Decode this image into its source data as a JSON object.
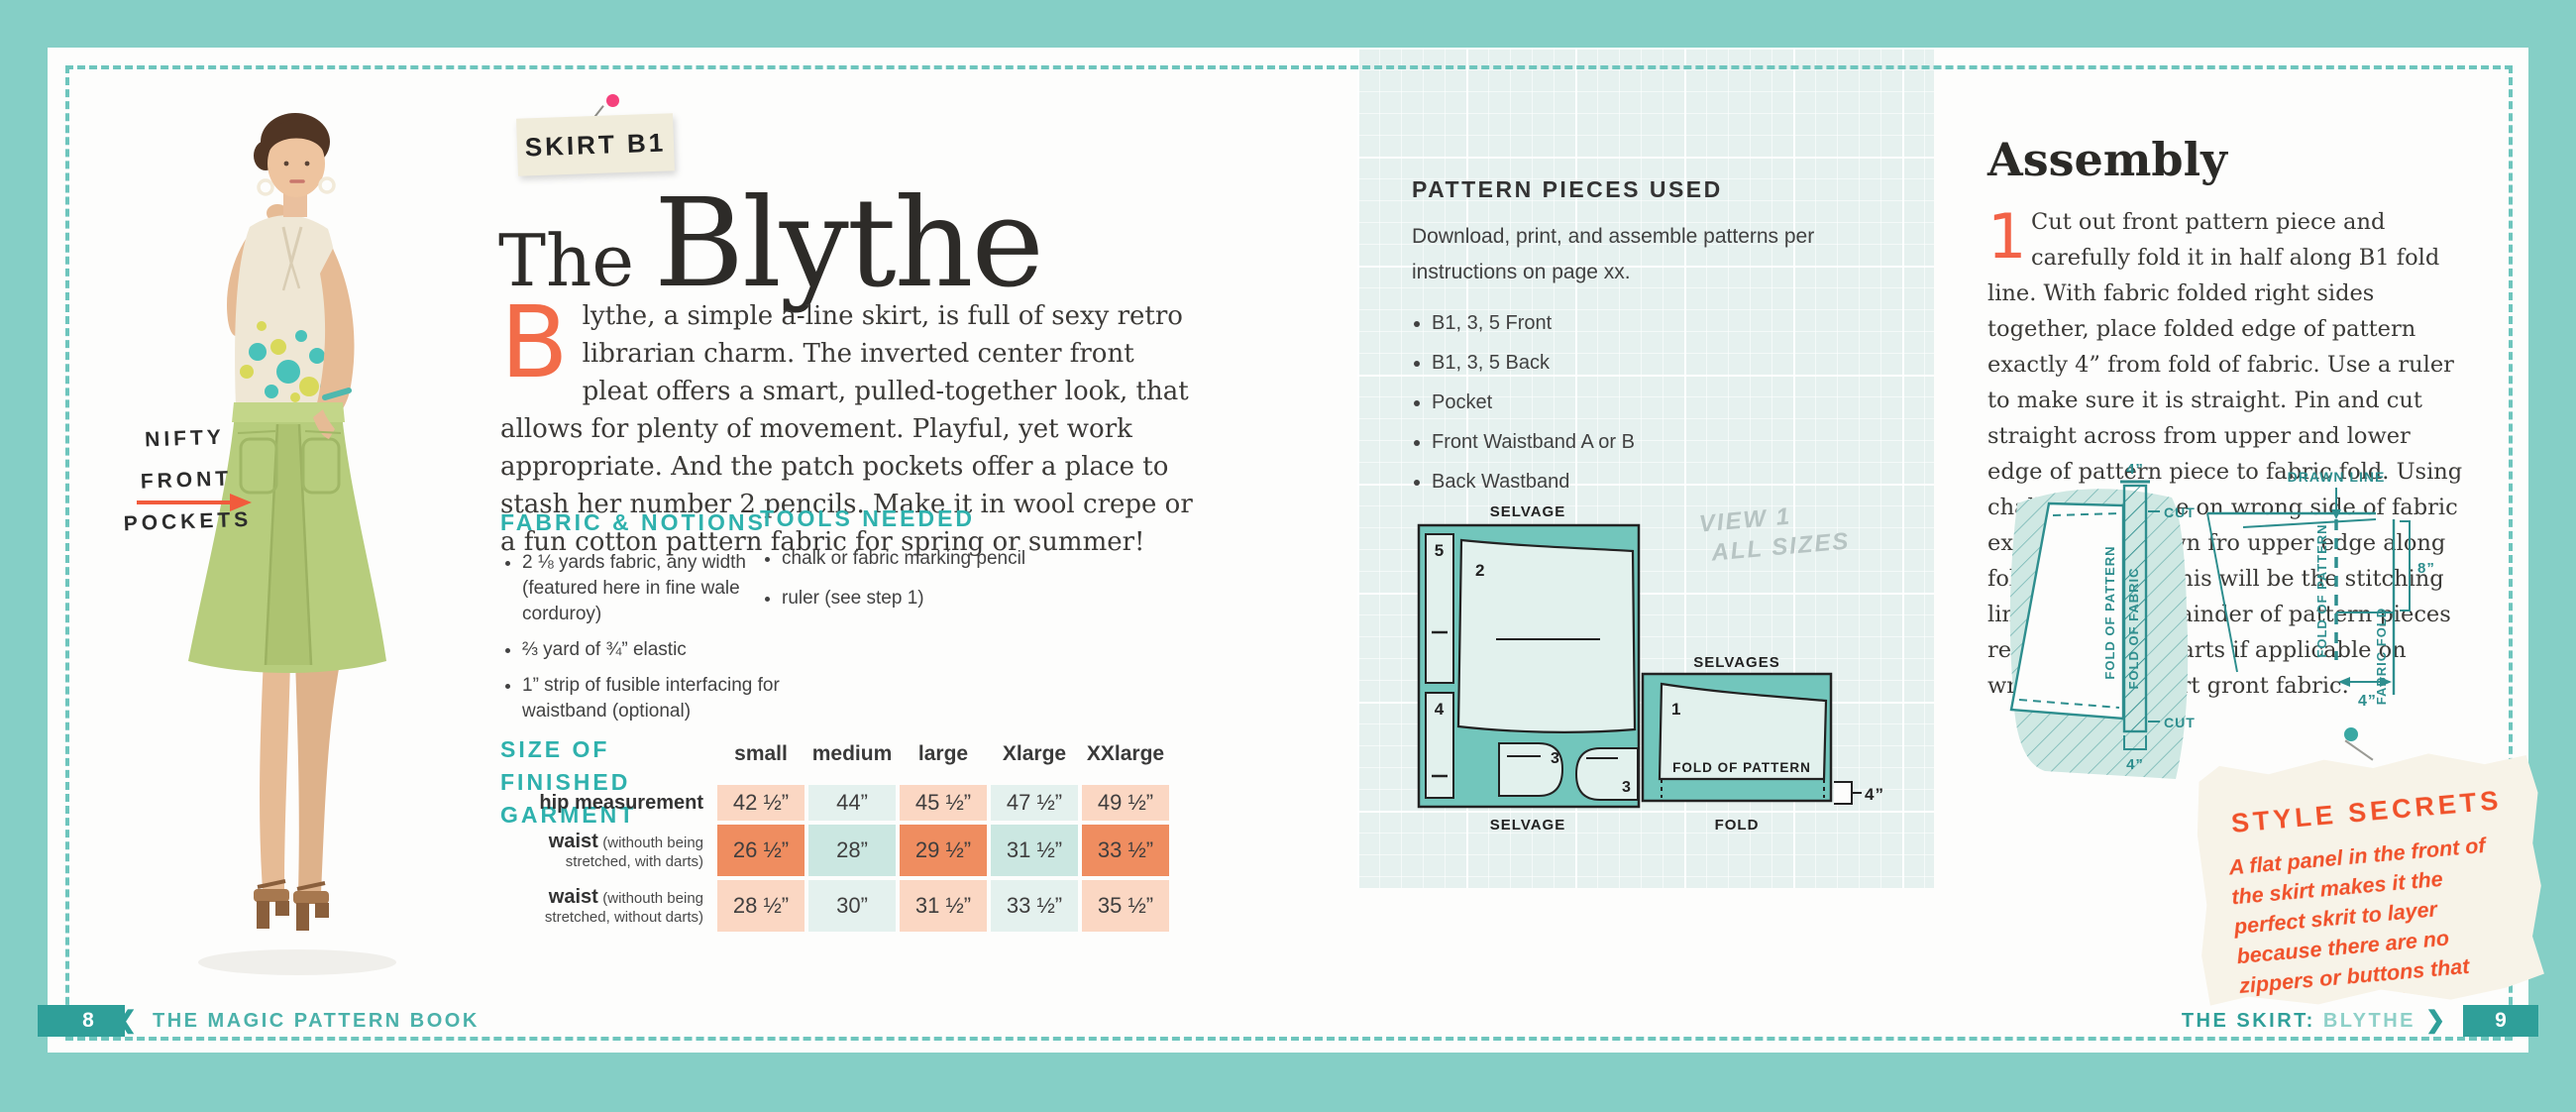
{
  "colors": {
    "background": "#85cfc6",
    "dashed_border": "#6ec5bd",
    "ribbon_teal": "#2f9f99",
    "heading_teal": "#2fb1ad",
    "accent_orange": "#f26247",
    "note_orange": "#f0512a",
    "table_peach": "#fbd7c3",
    "table_teal_light": "#e4f1ee",
    "table_orange": "#ef8d60",
    "table_teal_mid": "#cbe7e1",
    "skirt_green": "#b7cd7d"
  },
  "left_page": {
    "photo_annotation": {
      "line1": "NIFTY",
      "line2": "FRONT",
      "line3": "POCKETS"
    },
    "tag_label": "SKIRT B1",
    "title": {
      "small": "The",
      "large": "Blythe"
    },
    "intro": {
      "dropcap": "B",
      "text": "lythe, a simple a-line skirt, is full of sexy retro librarian charm. The inverted center front pleat offers a smart, pulled-together look, that allows for plenty of movement. Playful, yet work appropriate. And the patch pockets offer a place to stash her number 2 pencils. Make it in wool crepe or a fun cotton pattern fabric for spring or summer!"
    },
    "fabric_notions": {
      "heading": "FABRIC & NOTIONS",
      "items": [
        "2 ⅛ yards fabric, any width (featured here in fine wale corduroy)",
        "⅔ yard of ¾” elastic",
        "1” strip of fusible interfacing for waistband (optional)"
      ]
    },
    "tools": {
      "heading": "TOOLS NEEDED",
      "items": [
        "chalk or fabric marking pencil",
        "ruler (see step 1)"
      ]
    },
    "size_table": {
      "heading": [
        "SIZE OF FINISHED",
        "GARMENT"
      ],
      "columns": [
        "small",
        "medium",
        "large",
        "Xlarge",
        "XXlarge"
      ],
      "rows": [
        {
          "label": "hip measurement",
          "note": "",
          "values": [
            "42 ½”",
            "44”",
            "45 ½”",
            "47 ½”",
            "49 ½”"
          ]
        },
        {
          "label": "waist",
          "note": "(withouth being stretched, with darts)",
          "values": [
            "26 ½”",
            "28”",
            "29 ½”",
            "31 ½”",
            "33 ½”"
          ]
        },
        {
          "label": "waist",
          "note": "(withouth being stretched, without darts)",
          "values": [
            "28 ½”",
            "30”",
            "31 ½”",
            "33 ½”",
            "35 ½”"
          ]
        }
      ]
    },
    "footer": {
      "page_number": "8",
      "chevron": "❮",
      "title": "THE MAGIC PATTERN BOOK"
    }
  },
  "right_page": {
    "pattern_pieces": {
      "heading": "PATTERN PIECES USED",
      "intro": "Download, print, and assemble patterns per instructions on page xx.",
      "items": [
        "B1, 3, 5 Front",
        "B1, 3, 5 Back",
        "Pocket",
        "Front Waistband A or B",
        "Back Wastband"
      ]
    },
    "pencil_note": {
      "line1": "VIEW 1",
      "line2": "ALL SIZES"
    },
    "layout_diagram": {
      "selvage_top": "SELVAGE",
      "selvage_bottom": "SELVAGE",
      "selvages": "SELVAGES",
      "fold": "FOLD",
      "fold_of_pattern": "FOLD OF PATTERN",
      "measure_4": "4”",
      "piece_1": "1",
      "piece_2": "2",
      "piece_3a": "3",
      "piece_3b": "3",
      "piece_4": "4",
      "piece_5": "5"
    },
    "assembly": {
      "heading": "Assembly",
      "step_number": "1",
      "step_text": "Cut out front pattern piece and carefully fold it in half along B1 fold line. With fabric folded right sides together, place folded edge of pattern exactly 4” from fold of fabric. Use a ruler to make sure it is straight. Pin and cut straight across from upper and lower edge of pattern piece to fabric fold. Using chalk, draw a line on wrong side of fabric extending 8” down fro upper edge along fold of pattern. This will be the stitching line. Cut out remainder of pattern pieces required. Mark darts if applicable on wrong side of skirt gront fabric."
    },
    "fold_diagram": {
      "measure_top": "4”",
      "cut_top": "CUT",
      "cut_bottom": "CUT",
      "fold_of_pattern": "FOLD OF PATTERN",
      "fold_of_fabric": "FOLD OF FABRIC",
      "measure_bottom": "4”",
      "drawn_line": "DRAWN LINE",
      "measure_8": "8”",
      "fold_of_pattern_2": "FOLD OF PATTERN",
      "fabric_fold": "FABRIC FOLD",
      "measure_4": "4”"
    },
    "style_note": {
      "heading": "STYLE SECRETS",
      "text": "A flat panel in the front of the skirt makes it the perfect skrit to layer because there are no zippers or buttons that create extra bulk."
    },
    "footer": {
      "title_dark": "THE SKIRT:",
      "title_light": "BLYTHE",
      "chevron": "❯",
      "page_number": "9"
    }
  }
}
